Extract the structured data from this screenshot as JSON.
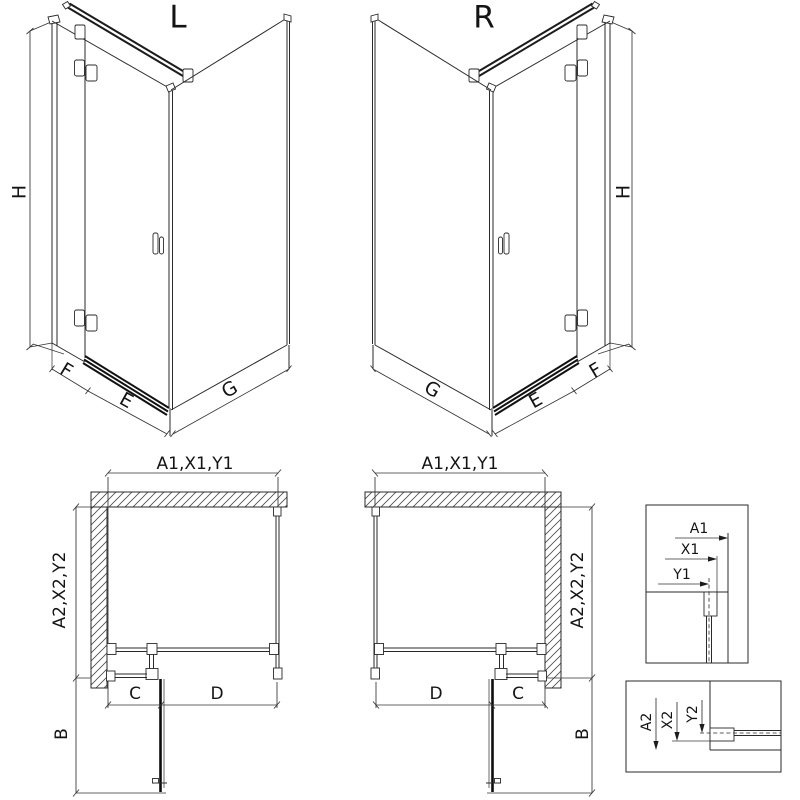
{
  "page": {
    "background": "#ffffff",
    "line_color": "#2a2a2a"
  },
  "iso_left": {
    "variant_label": "L",
    "height_label": "H",
    "fixed_label": "F",
    "door_label": "E",
    "side_label": "G"
  },
  "iso_right": {
    "variant_label": "R",
    "height_label": "H",
    "fixed_label": "F",
    "door_label": "E",
    "side_label": "G"
  },
  "plan_left": {
    "width_label": "A1,X1,Y1",
    "depth_label": "A2,X2,Y2",
    "fixed_label": "C",
    "door_label": "D",
    "swing_label": "B"
  },
  "plan_right": {
    "width_label": "A1,X1,Y1",
    "depth_label": "A2,X2,Y2",
    "fixed_label": "C",
    "door_label": "D",
    "swing_label": "B"
  },
  "detail_front": {
    "overall_label": "A1",
    "profile_label": "X1",
    "glass_label": "Y1"
  },
  "detail_side": {
    "overall_label": "A2",
    "profile_label": "X2",
    "glass_label": "Y2"
  }
}
